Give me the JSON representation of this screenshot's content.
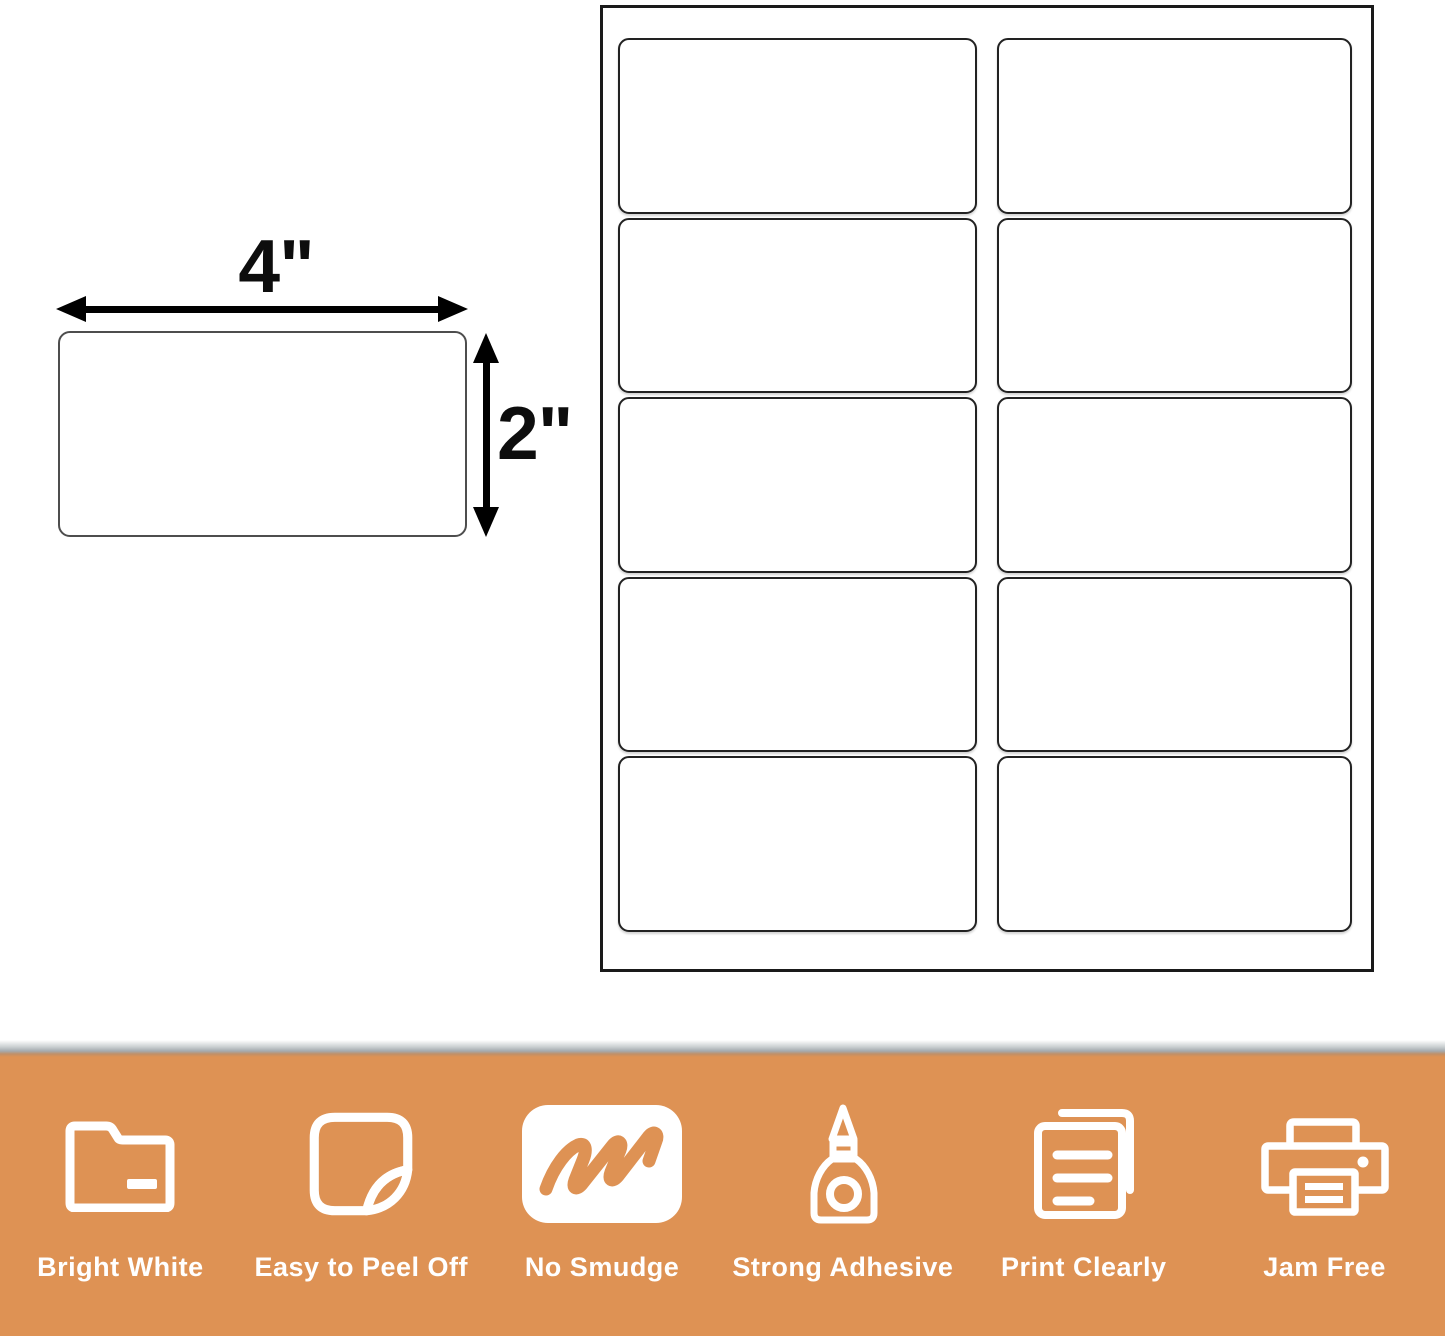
{
  "colors": {
    "accent": "#DE9254",
    "ink": "#0d0d0d",
    "sheet_border": "#1a1a1a",
    "label_border": "#222222",
    "diagram_border": "#4d4d4d",
    "banner_text": "#ffffff"
  },
  "diagram": {
    "width_label": "4\"",
    "height_label": "2\""
  },
  "sheet": {
    "rows": 5,
    "columns": 2
  },
  "banner": {
    "features": [
      {
        "label": "Bright White",
        "icon": "folder-icon"
      },
      {
        "label": "Easy to Peel Off",
        "icon": "peel-sticker-icon"
      },
      {
        "label": "No Smudge",
        "icon": "no-smudge-marker-icon"
      },
      {
        "label": "Strong Adhesive",
        "icon": "glue-bottle-icon"
      },
      {
        "label": "Print Clearly",
        "icon": "document-pages-icon"
      },
      {
        "label": "Jam Free",
        "icon": "printer-icon"
      }
    ]
  }
}
